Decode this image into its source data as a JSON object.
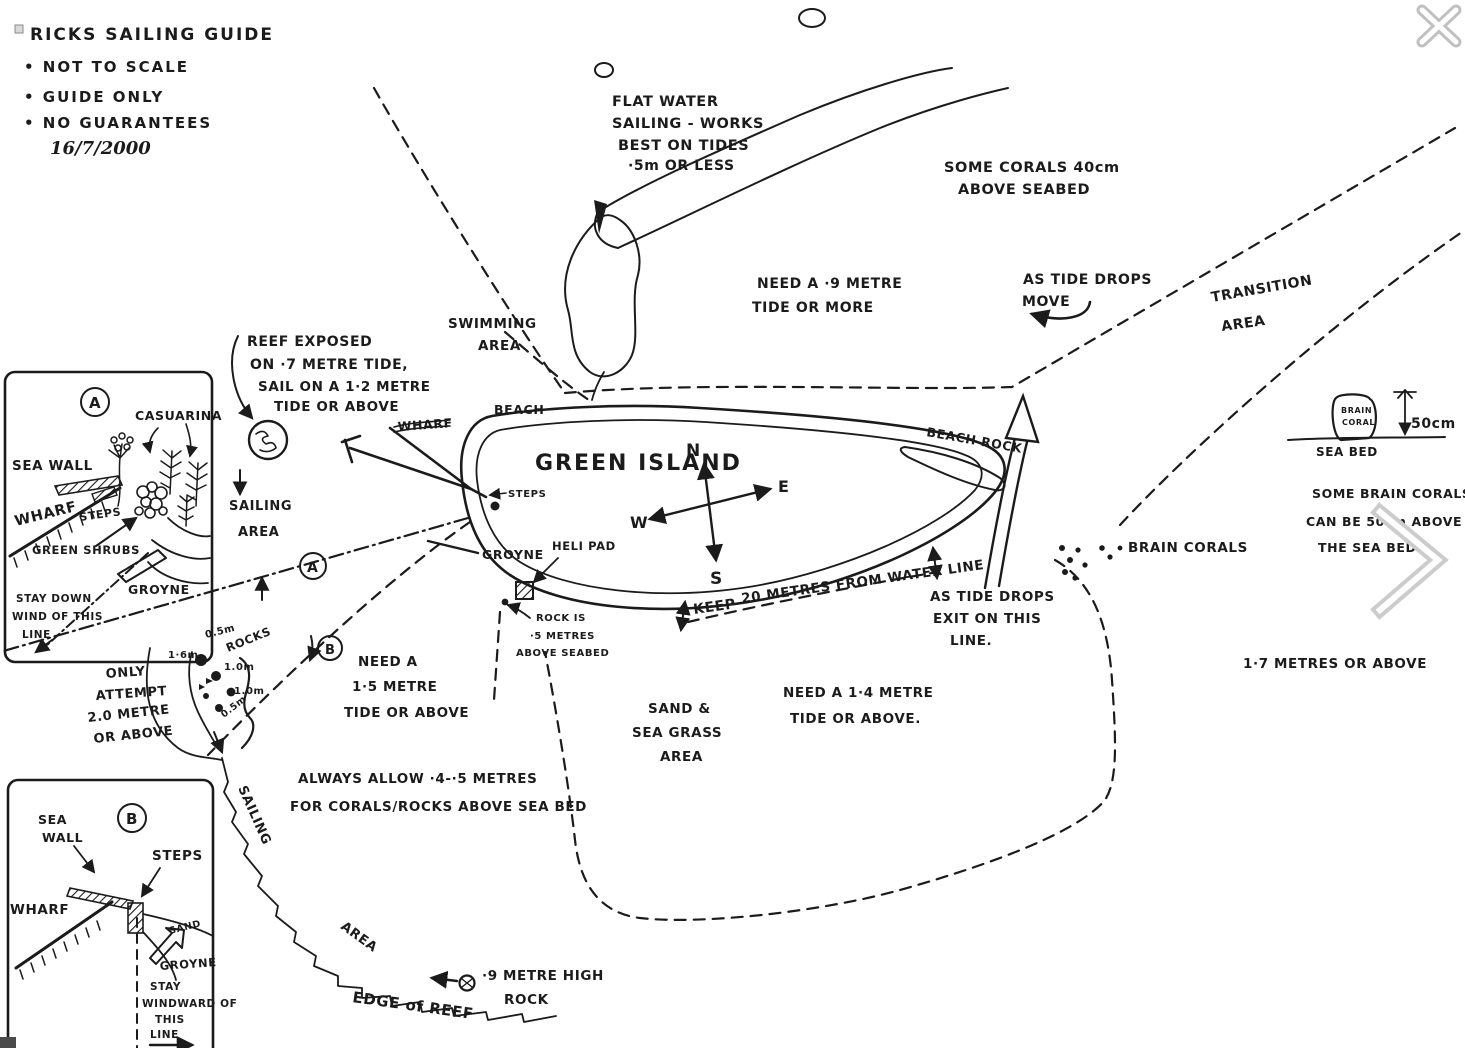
{
  "colors": {
    "ink": "#1b1b1b",
    "ui_gray": "#c6c6c6",
    "dark_square": "#4a4a4a"
  },
  "title_block": {
    "title": "RICKS SAILING GUIDE",
    "bullet1": "• NOT TO SCALE",
    "bullet2": "• GUIDE ONLY",
    "bullet3": "• NO GUARANTEES",
    "date": "16/7/2000"
  },
  "island": {
    "name": "GREEN ISLAND",
    "beach": "BEACH",
    "beach_rock": "BEACH ROCK",
    "wharf": "WHARF",
    "steps": "STEPS",
    "groyne": "GROYNE",
    "heli_pad": "HELI PAD"
  },
  "compass": {
    "n": "N",
    "e": "E",
    "s": "S",
    "w": "W"
  },
  "labels": {
    "flat_water": [
      "FLAT WATER",
      "SAILING - WORKS",
      "BEST ON TIDES",
      "·5m OR LESS"
    ],
    "some_corals": [
      "SOME CORALS 40cm",
      "ABOVE SEABED"
    ],
    "need_9": [
      "NEED A ·9 METRE",
      "TIDE OR MORE"
    ],
    "tide_drops_move": [
      "AS TIDE DROPS",
      "MOVE"
    ],
    "transition": [
      "TRANSITION",
      "AREA"
    ],
    "swimming": [
      "SWIMMING",
      "AREA"
    ],
    "reef_exposed": [
      "REEF EXPOSED",
      "ON ·7 METRE TIDE,",
      "SAIL ON A 1·2 METRE",
      "TIDE OR ABOVE"
    ],
    "sailing_area_left": [
      "SAILING",
      "AREA"
    ],
    "keep": "KEEP",
    "keep20": "20 METRES FROM WATER LINE",
    "exit_line": [
      "AS TIDE DROPS",
      "EXIT ON THIS",
      "LINE."
    ],
    "rock_is": [
      "ROCK IS",
      "·5 METRES",
      "ABOVE SEABED"
    ],
    "need_15": [
      "NEED A",
      "1·5 METRE",
      "TIDE OR ABOVE"
    ],
    "only_attempt": [
      "ONLY",
      "ATTEMPT",
      "2.0 METRE",
      "OR ABOVE"
    ],
    "rocks": "ROCKS",
    "depth_05a": "0.5m",
    "depth_16": "1·6m",
    "depth_10a": "1.0m",
    "depth_10b": "1.0m",
    "depth_05b": "0.5m",
    "always_allow": [
      "ALWAYS ALLOW ·4-·5 METRES",
      "FOR CORALS/ROCKS ABOVE SEA BED"
    ],
    "sand_grass": [
      "SAND &",
      "SEA GRASS",
      "AREA"
    ],
    "need_14": [
      "NEED A 1·4 METRE",
      "TIDE OR ABOVE."
    ],
    "sailing_reef": "SAILING",
    "area_reef": "AREA",
    "edge_reef": "EDGE of REEF",
    "rock_9m": [
      "·9 METRE HIGH",
      "ROCK"
    ],
    "brain_corals": "BRAIN CORALS",
    "some_brain": [
      "SOME BRAIN CORALS",
      "CAN BE 50cm ABOVE",
      "THE SEA BED"
    ],
    "m17": "1·7 METRES OR ABOVE",
    "brain_blob": [
      "BRAIN",
      "CORAL"
    ],
    "cm50": "50cm",
    "sea_bed": "SEA BED",
    "marker_a": "A",
    "marker_b": "B"
  },
  "inset_a": {
    "letter": "A",
    "casuarina": "CASUARINA",
    "sea_wall": "SEA WALL",
    "wharf": "WHARF",
    "steps": "STEPS",
    "green_shrubs": "GREEN SHRUBS",
    "groyne": "GROYNE",
    "stay": [
      "STAY DOWN",
      "WIND OF THIS",
      "LINE"
    ]
  },
  "inset_b": {
    "letter": "B",
    "sea_wall": [
      "SEA",
      "WALL"
    ],
    "wharf": "WHARF",
    "steps": "STEPS",
    "sand": "SAND",
    "groyne": "GROYNE",
    "stay": [
      "STAY",
      "WINDWARD OF",
      "THIS",
      "LINE"
    ]
  }
}
